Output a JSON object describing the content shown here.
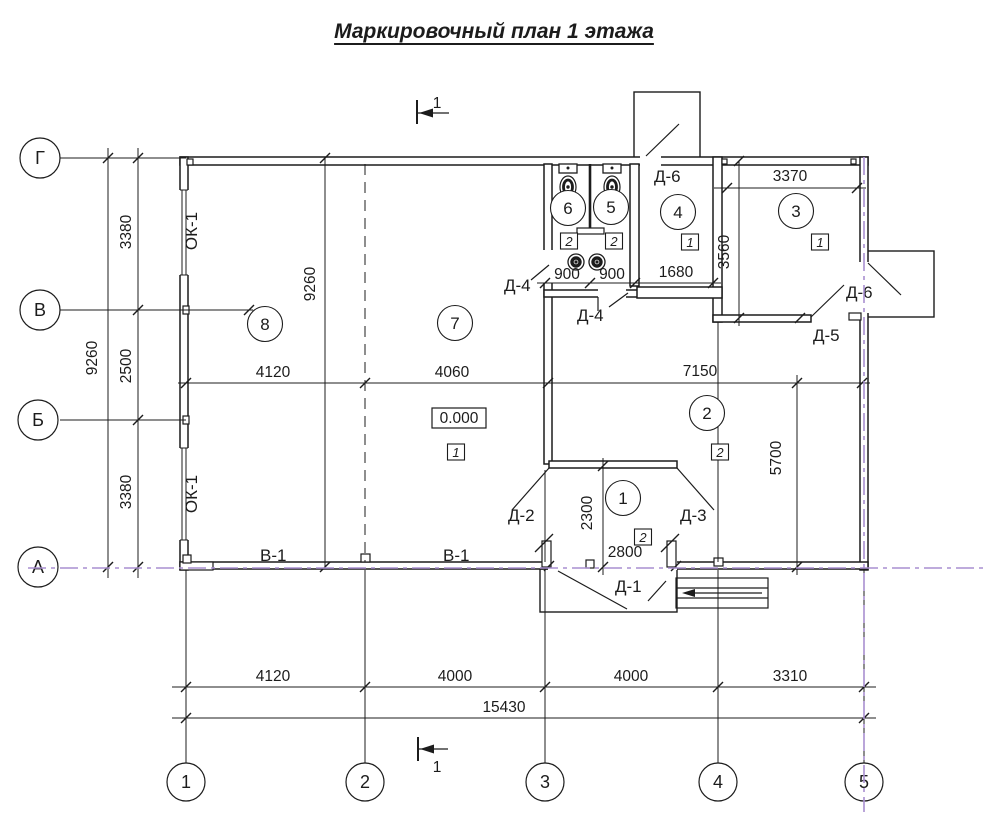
{
  "title": "Маркировочный план 1 этажа",
  "section_mark": "1",
  "axes": {
    "rows": [
      "Г",
      "В",
      "Б",
      "А"
    ],
    "cols": [
      "1",
      "2",
      "3",
      "4",
      "5"
    ]
  },
  "rooms": {
    "r1": {
      "number": "1",
      "mark": "2"
    },
    "r2": {
      "number": "2",
      "mark": "2"
    },
    "r3": {
      "number": "3",
      "mark": "1"
    },
    "r4": {
      "number": "4",
      "mark": "1"
    },
    "r5": {
      "number": "5",
      "mark": "2"
    },
    "r6": {
      "number": "6",
      "mark": "2"
    },
    "r7": {
      "number": "7",
      "mark": "1"
    },
    "r8": {
      "number": "8"
    }
  },
  "level_mark": "0.000",
  "labels": {
    "door_d1": "Д-1",
    "door_d2": "Д-2",
    "door_d3": "Д-3",
    "door_d4": "Д-4",
    "door_d5": "Д-5",
    "door_d6": "Д-6",
    "window_ok1": "ОК-1",
    "gate_v1": "В-1"
  },
  "dims": {
    "left_total": "9260",
    "left_g_v": "3380",
    "left_v_b": "2500",
    "left_b_a": "3380",
    "inplan_height": "9260",
    "mid_1": "4120",
    "mid_2": "4060",
    "mid_3": "7150",
    "wc_1": "900",
    "wc_2": "900",
    "wc_3": "1680",
    "room3_width": "3370",
    "room3_height": "3560",
    "room2_height": "5700",
    "vestibule_depth": "2300",
    "entrance_width": "2800",
    "bottom_1": "4120",
    "bottom_2": "4000",
    "bottom_3": "4000",
    "bottom_4": "3310",
    "bottom_total": "15430"
  },
  "colors": {
    "line": "#1c1c1c",
    "axis_highlight": "#a98fd0",
    "background": "#ffffff"
  }
}
